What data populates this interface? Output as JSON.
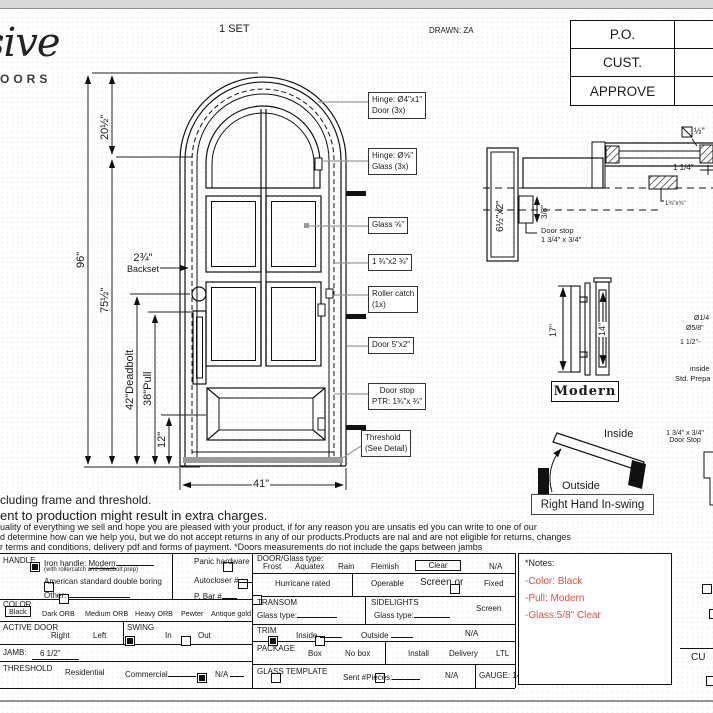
{
  "page": {
    "set_label": "1 SET",
    "drawn_by": "DRAWN: ZA",
    "logo_script": "sive",
    "logo_word": "OORS",
    "corner_sig": "CU",
    "approval_rows": [
      "P.O.",
      "CUST.",
      "APPROVE"
    ]
  },
  "door": {
    "dim_arch": "20½\"",
    "dim_total": "96\"",
    "dim_leaf": "75½\"",
    "dim_deadbolt": "42\"Deadbolt",
    "dim_pull": "38\"Pull",
    "dim_bottom": "12\"",
    "backset_value": "2¾\"",
    "backset_label": "Backset",
    "dim_width": "41\"",
    "callout_hinge_door_1": "Hinge: Ø4\"x1\"",
    "callout_hinge_door_2": "Door (3x)",
    "callout_hinge_glass_1": "Hinge: Ø⅝\"",
    "callout_hinge_glass_2": "Glass (3x)",
    "callout_glass": "Glass ⅝\"",
    "callout_mullion": "1 ¾\"x2 ¾\"",
    "callout_roller_1": "Roller catch",
    "callout_roller_2": "(1x)",
    "callout_lock": "Door 5\"x2\"",
    "callout_stop_1": "Door stop",
    "callout_stop_2": "PTR: 1¾\"x ¾\"",
    "callout_threshold_1": "Threshold",
    "callout_threshold_2": "(See Detail)"
  },
  "head_detail": {
    "jamb_size": "6½\"x2\"",
    "stop_offset": "3/8\"",
    "stop_label_1": "Door stop",
    "stop_label_2": "1 3/4\" x 3/4\"",
    "square_dim": "½\"",
    "dim_quarter": "1 1/4\"",
    "hatch_dim": "1¾\"x¾\""
  },
  "handle_detail": {
    "dim_17": "17\"",
    "dim_14": "14\"",
    "style_label": "Modern",
    "edge_1": "Ø1/4",
    "edge_2": "Ø5/8\"",
    "edge_3": "1 1/2\"-",
    "edge_4": "inside",
    "edge_5": "Std. Prepa"
  },
  "swing": {
    "inside": "Inside",
    "outside": "Outside",
    "label": "Right Hand In-swing",
    "stop_1": "1 3/4\" x 3/4\"",
    "stop_2": "Door Stop"
  },
  "disclaimer": {
    "line1": "cluding frame and threshold.",
    "line2": "ent to production might result in extra charges.",
    "line3": "uality of everything we sell and hope you are pleased with your product, if for any reason you are unsatis  ed you can write to one of our",
    "line4": "d determine how can we help you, but we do not accept returns in any of our products.Products are  nal and are not eligible for returns, changes",
    "line5": "r terms and conditions, delivery pdf and forms of payment. *Doors measurements do not include the gaps between jambs"
  },
  "form": {
    "handle_label": "HANDLE",
    "iron_handle": "Iron handle:",
    "iron_handle_value": "Modern",
    "iron_handle_sub": "(with rollercatch and deadbolt prep)",
    "american": "American standard double boring",
    "other": "Other:",
    "panic": "Panic hardware",
    "autocloser": "Autocloser #",
    "pbar": "P. Bar #",
    "color_label": "COLOR",
    "color_black": "Black",
    "color_dark": "Dark ORB",
    "color_medium": "Medium ORB",
    "color_heavy": "Heavy ORB",
    "color_pewter": "Pewter",
    "color_antique": "Antique gold",
    "active_label": "ACTIVE DOOR",
    "active_right": "Right",
    "active_left": "Left",
    "swing_label": "SWING",
    "swing_in": "In",
    "swing_out": "Out",
    "jamb_label": "JAMB:",
    "jamb_value": "6 1/2\"",
    "threshold_label": "THRESHOLD",
    "threshold_res": "Residential",
    "threshold_com": "Commercial",
    "threshold_na": "N/A",
    "doorglass_label": "DOOR/Glass type:",
    "glass_frost": "Frost",
    "glass_aquatex": "Aquatex",
    "glass_rain": "Rain",
    "glass_flemish": "Flemish",
    "glass_clear": "Clear",
    "glass_na": "N/A",
    "hurricane": "Hurricane rated",
    "operable": "Operable",
    "screen_or": "Screen or",
    "fixed": "Fixed",
    "transom_label": "TRANSOM",
    "transom_glass": "Glass type:",
    "sidelights_label": "SIDELIGHTS",
    "sidelights_glass": "Glass type:",
    "sidelights_screen": "Screen",
    "trim_label": "TRIM",
    "trim_inside": "Inside",
    "trim_outside": "Outside",
    "trim_na": "N/A",
    "package_label": "PACKAGE",
    "package_box": "Box",
    "package_nobox": "No box",
    "package_install": "Install",
    "package_delivery": "Delivery",
    "package_ltl": "LTL",
    "template_label": "GLASS TEMPLATE",
    "template_sent": "Sent #Pieces:",
    "template_na": "N/A",
    "gauge": "GAUGE: 14"
  },
  "notes": {
    "title": "*Notes:",
    "line1": "-Color: Black",
    "line2": "-Pull: Modern",
    "line3": "-Glass:5/8\"  Clear",
    "accent": "#ee4b40"
  }
}
